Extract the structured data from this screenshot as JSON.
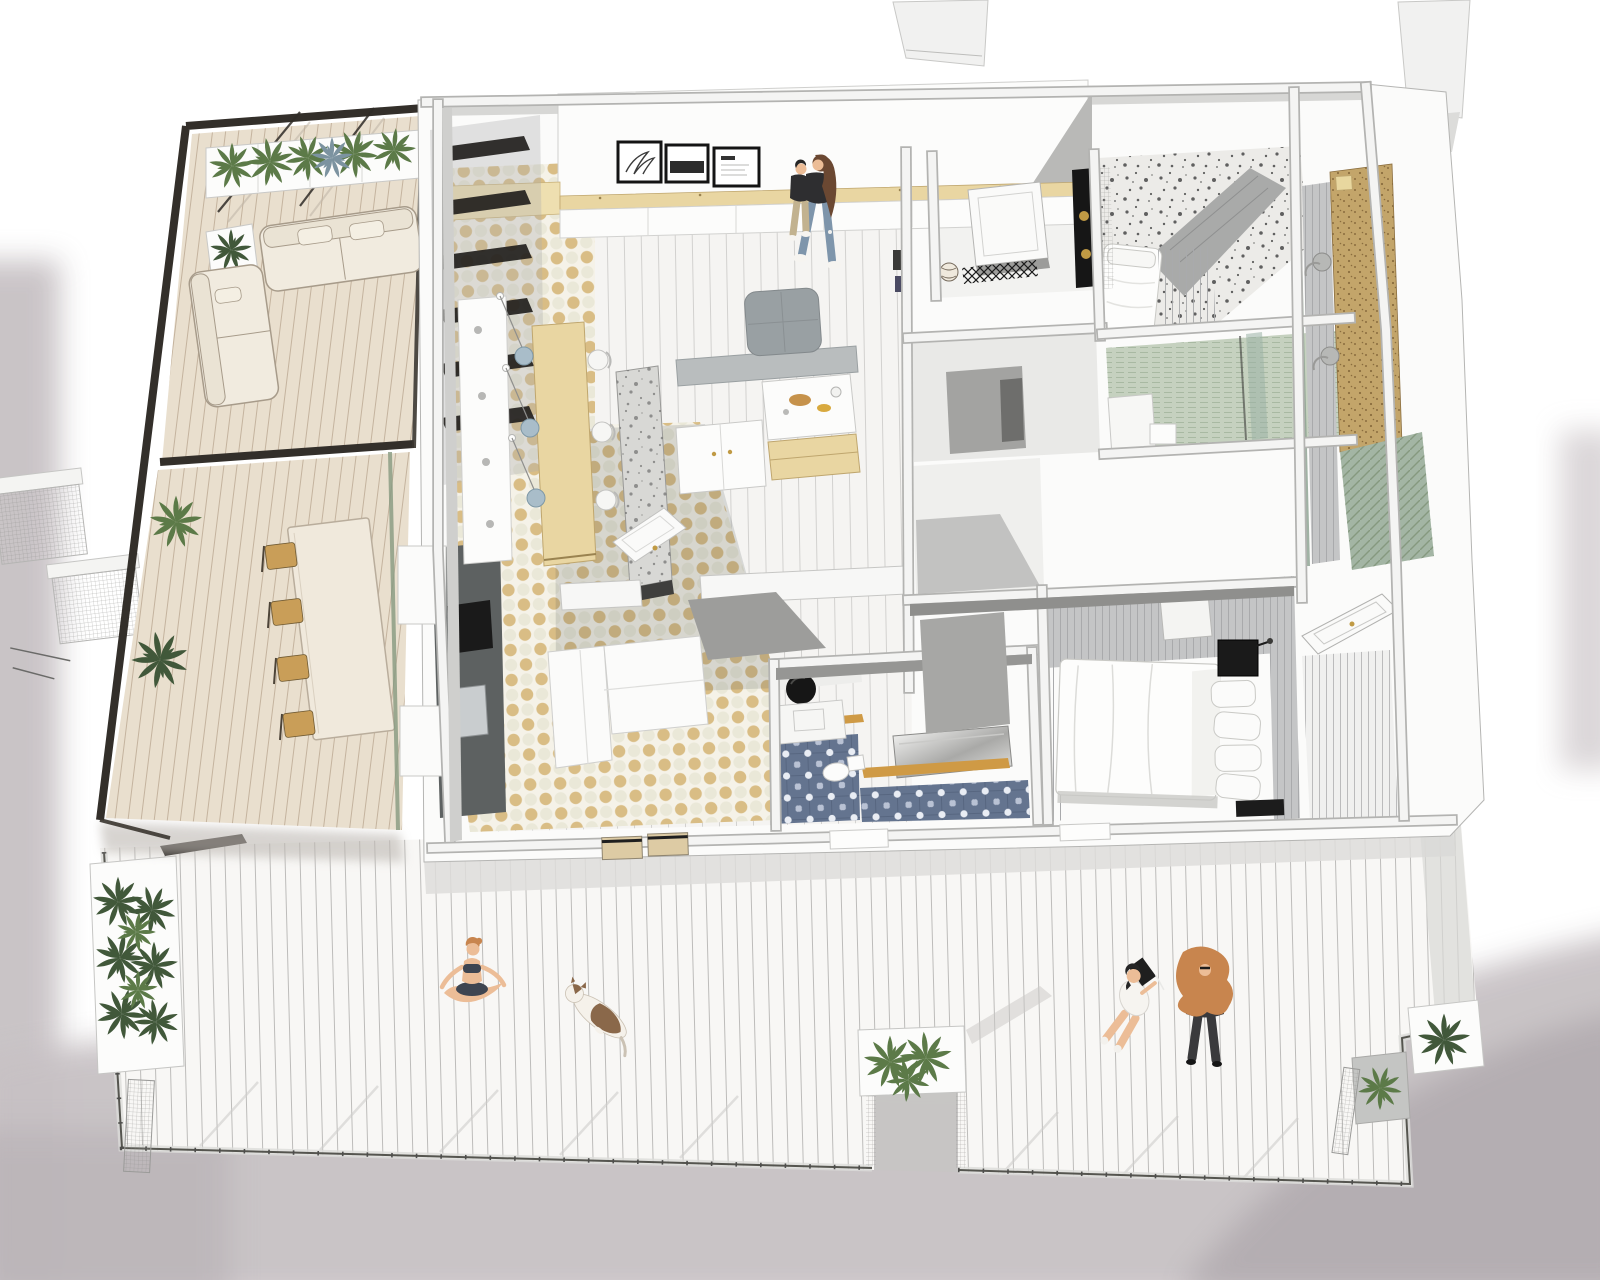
{
  "scene": {
    "title": "Axonometric cutaway rendering of an apartment floor plan with wraparound roof deck",
    "view": "3D top-down axonometric, SketchUp-style, walls cut at chest height",
    "has_visible_text": false,
    "background": "white paper with soft grey watercolor wash at left, bottom and right edges"
  },
  "palette": {
    "background": "#ffffff",
    "wash": "#c7c1c4",
    "washDark": "#b2acb0",
    "washLight": "#d8d3d5",
    "wallWhite": "#fbfbfa",
    "wallEdge": "#b3b3b1",
    "wallFaceGray": "#9c9c9a",
    "deckFloor": "#f8f7f5",
    "railDark": "#55554f",
    "terraceFloor": "#e9dfce",
    "pergolaFrame": "#332f2a",
    "planterWhite": "#fcfcfb",
    "plantGreen": "#5c7a48",
    "plantDarkGreen": "#41583a",
    "plantBlueGreen": "#7c93a0",
    "sofaCream": "#f1ebdf",
    "tableCream": "#f0e9dc",
    "chairTan": "#c99e58",
    "islandWood": "#e9d6a2",
    "counterDark": "#5d6161",
    "applianceBlack": "#1a1a1a",
    "sinkSteel": "#c9cdcf",
    "checkerBase": "#f5f2e8",
    "checkerTan": "#d9bd85",
    "checkerPale": "#eae8d8",
    "livingFloor": "#f5f4f2",
    "terrazzoFloor": "#ecebe8",
    "terrazzoSpeck": "#474747",
    "bathTileBlue": "#64748f",
    "bathFloorGreen": "#c5d1bf",
    "sageGreen": "#8aa08f",
    "corkWall": "#c3a56a",
    "panelGray": "#c4c5c6",
    "ottomanGray": "#99a0a3",
    "benchGray": "#b9bdbe",
    "pendantBlue": "#a9bdc9",
    "brassGold": "#c09a44",
    "bedWhite": "#fdfdfc",
    "woodShelf": "#cf9a45",
    "skin": "#ecbd97",
    "hairBrown": "#6b4832",
    "hairGinger": "#c8854e",
    "jeansBlue": "#7e95ab",
    "khakiPants": "#c2b28f",
    "clothingDark": "#2e2e30",
    "shirtWhite": "#f6f4f0",
    "dogBrown": "#8a684a"
  },
  "building": {
    "rooms": [
      {
        "name": "kitchen-dining",
        "floor": "beige and white checkerboard tile",
        "features": [
          "plywood dining island with pendant lamps",
          "terrazzo island counter",
          "dark counter run with sink and cooktop",
          "white cabinets",
          "grey bench"
        ]
      },
      {
        "name": "living-room",
        "floor": "pale wood planks",
        "features": [
          "grey ottoman",
          "white sectional sofa",
          "gallery wall with three framed prints",
          "plywood wall shelf"
        ]
      },
      {
        "name": "family-bathroom",
        "floor": "blue patterned encaustic tile",
        "features": [
          "round black mirror",
          "white vanity",
          "toilet",
          "walnut shelf",
          "reflective bathtub"
        ]
      },
      {
        "name": "laundry-room",
        "floor": "white",
        "features": [
          "leaning mirror",
          "lattice tile strip",
          "woven basket",
          "brass knobs on dark cabinet"
        ]
      },
      {
        "name": "terrazzo-bathroom",
        "floor": "white terrazzo with dark speckles",
        "features": [
          "single bed with white bedding"
        ]
      },
      {
        "name": "green-bathroom",
        "floor": "sage green tile",
        "features": [
          "white fixtures",
          "glass partition"
        ]
      },
      {
        "name": "master-bedroom",
        "floor": "grey",
        "features": [
          "double bed with white duvet",
          "stacked pillows",
          "black cube nightstand",
          "grey plank walls"
        ]
      },
      {
        "name": "entry-hall",
        "floor": "grey planks",
        "features": [
          "white panelled front door with brass knob"
        ]
      }
    ]
  },
  "outdoor": {
    "lounge_terrace": {
      "floor": "warm beige decking",
      "frame": "dark timber pergola frame",
      "furniture": [
        "cream two-seat sofa",
        "cream lounge chair"
      ],
      "planters": "row of white planters with green plants"
    },
    "dining_terrace": {
      "floor": "warm beige decking",
      "furniture": [
        "long cream dining table",
        "four tan chairs"
      ],
      "plants": 2
    },
    "side_balcony": {
      "floor": "grey planks and sage diagonal decking",
      "wall": "cork-look panel",
      "furniture": [
        "two small round bistro tables"
      ]
    },
    "roof_deck": {
      "floor": "white painted planks",
      "railing": "thin dark metal railing with mesh",
      "planters": [
        "tall white planter at left",
        "white planter box in centre notch",
        "two corner planters at right"
      ]
    }
  },
  "people": [
    {
      "name": "woman-carrying-child",
      "location": "living room",
      "details": "long brown hair, black top, blue jeans; child in black top and khaki trousers"
    },
    {
      "name": "yoga-woman",
      "location": "roof deck",
      "details": "seated cross-legged, dark two-piece outfit, ginger hair"
    },
    {
      "name": "reading-person",
      "location": "roof deck",
      "details": "white shirt, dark hair, holding black book"
    },
    {
      "name": "standing-person",
      "location": "roof deck",
      "details": "long curly ginger hair, dark outfit, viewed from above"
    }
  ],
  "animals": [
    {
      "name": "dog",
      "location": "roof deck",
      "details": "white dog with brown patches lying diagonally"
    }
  ],
  "artwork": {
    "frames": 3,
    "description": "three black-framed monochrome prints on living room wall; captions illegible"
  }
}
